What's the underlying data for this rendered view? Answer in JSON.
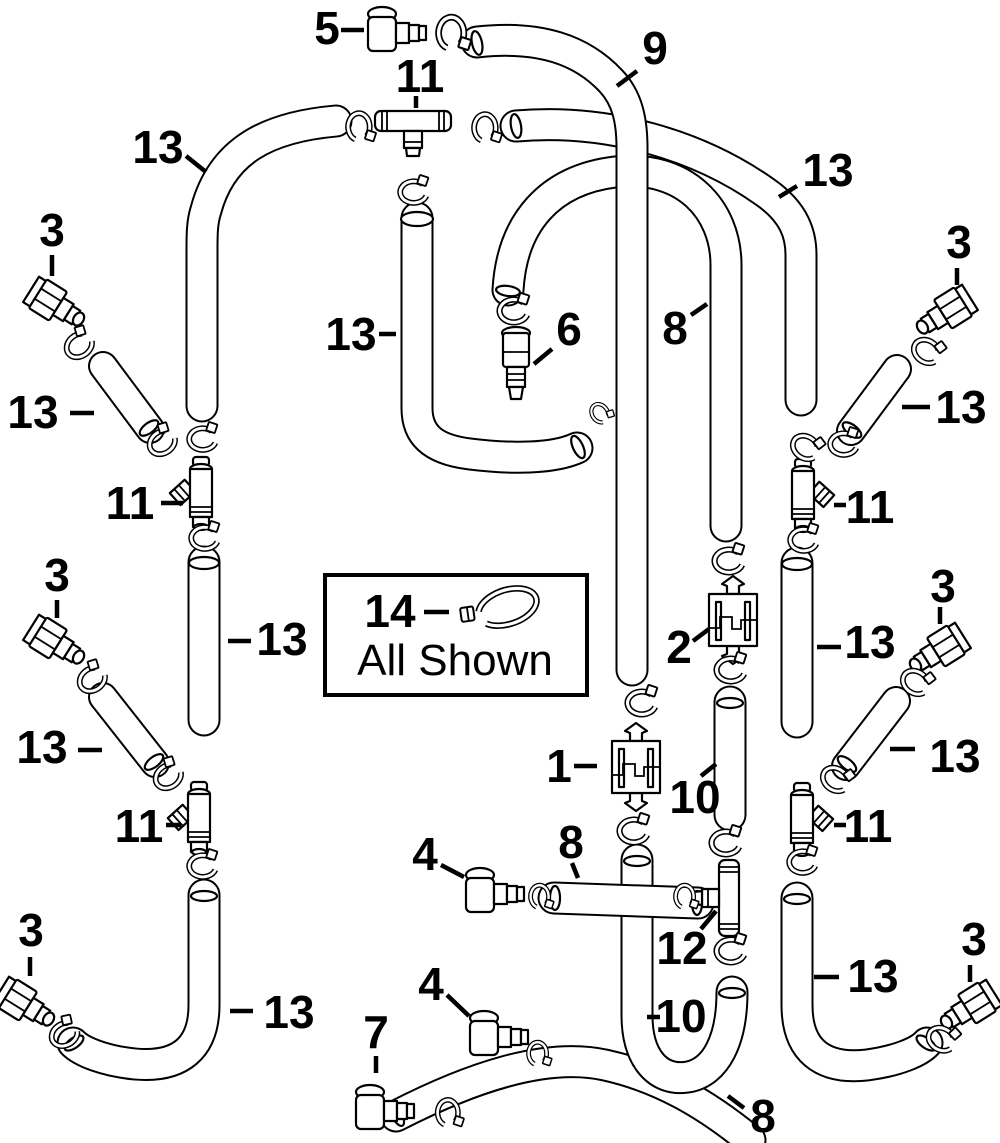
{
  "diagram": {
    "colors": {
      "background": "#ffffff",
      "line": "#000000"
    },
    "legend": {
      "number": "14",
      "note": "All Shown",
      "icon": "cable-tie-icon"
    },
    "callouts": {
      "c5": "5",
      "c11_top": "11",
      "c9": "9",
      "c13_top_left": "13",
      "c13_top_right": "13",
      "c3_top_left": "3",
      "c3_top_right": "3",
      "c13_left_1": "13",
      "c13_right_1": "13",
      "c13_center_top": "13",
      "c6": "6",
      "c8_top": "8",
      "c11_left_1": "11",
      "c11_right_1": "11",
      "c3_left_2": "3",
      "c3_right_2": "3",
      "c13_center_left": "13",
      "c2": "2",
      "c13_center_right": "13",
      "c13_left_2": "13",
      "c13_right_2": "13",
      "c1": "1",
      "c10_center": "10",
      "c11_left_2": "11",
      "c11_right_2": "11",
      "c4_upper": "4",
      "c8_center": "8",
      "c12": "12",
      "c4_lower": "4",
      "c7": "7",
      "c10_bottom": "10",
      "c3_bottom_left": "3",
      "c13_bottom_left": "13",
      "c13_bottom_right": "13",
      "c3_bottom_right": "3",
      "c8_bottom": "8"
    }
  }
}
